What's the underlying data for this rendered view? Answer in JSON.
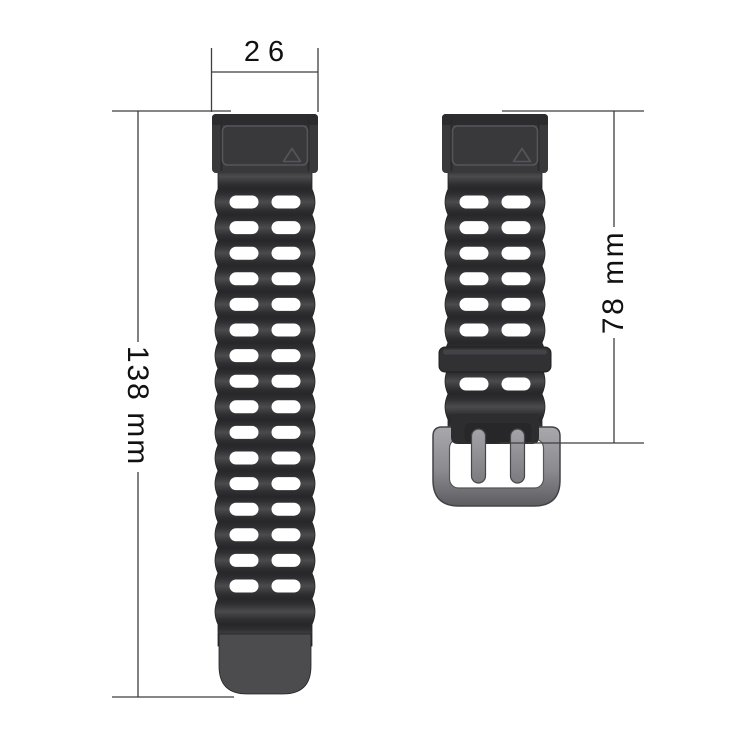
{
  "diagram": {
    "type": "product dimension drawing",
    "subject": "two-piece silicone watch strap with quick-release connectors and buckle",
    "labels": {
      "strap_width": "26",
      "long_strap_length": "138 mm",
      "short_strap_length": "78 mm"
    }
  },
  "colors": {
    "background": "#ffffff",
    "dimension_line": "#3f3f3f",
    "dimension_text": "#111111",
    "connector_body": "#39393c",
    "connector_top_band": "#2c2c2e",
    "connector_detail_line": "#56565a",
    "strap_ridge_dark": "#27272a",
    "strap_ridge_light": "#4b4b4e",
    "strap_edge": "#232325",
    "strap_tip": "#4c4c4f",
    "hole": "#ffffff",
    "keeper": "#313134",
    "keeper_highlight": "#47474b",
    "strap_end": "#2d2d30",
    "crossbar": "#27272a",
    "buckle_metal_light": "#a9a9ad",
    "buckle_metal_mid": "#8b8b8f",
    "buckle_metal_dark": "#5d5d61",
    "buckle_outline": "#434347"
  }
}
